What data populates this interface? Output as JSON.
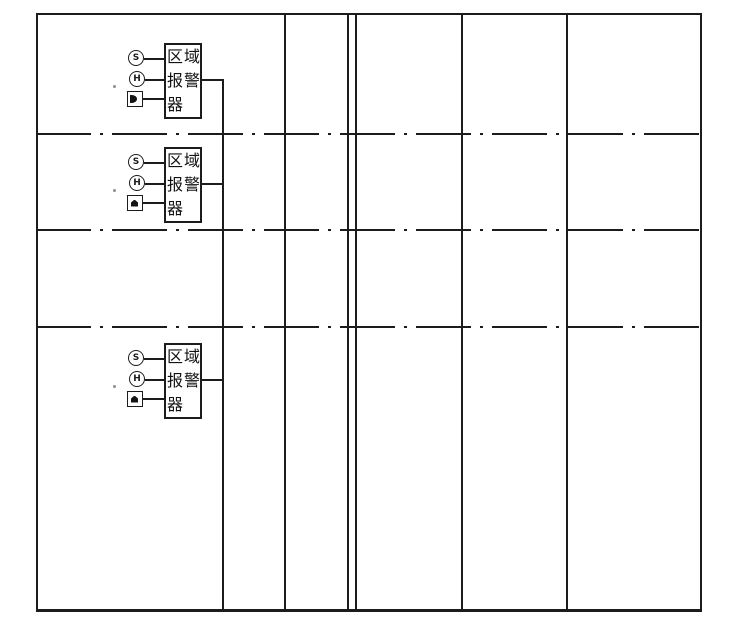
{
  "colors": {
    "line": "#1c1c1c",
    "background": "#ffffff"
  },
  "alarm_units": [
    {
      "smoke_detector_label": "S",
      "heat_detector_label": "H",
      "box_lines": [
        "区域",
        "报警",
        "器"
      ]
    },
    {
      "smoke_detector_label": "S",
      "heat_detector_label": "H",
      "box_lines": [
        "区域",
        "报警",
        "器"
      ]
    },
    {
      "smoke_detector_label": "S",
      "heat_detector_label": "H",
      "box_lines": [
        "区域",
        "报警",
        "器"
      ]
    }
  ]
}
